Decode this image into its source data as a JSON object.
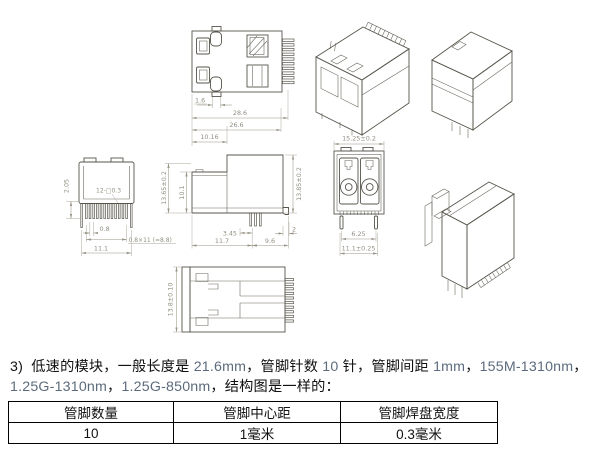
{
  "drawing": {
    "dims": {
      "top_tab": "1.6",
      "w_outer": "28.6",
      "w_body": "26.6",
      "w_nose": "10.16",
      "h_left": "13.65±0.2",
      "h_inner": "10.1",
      "h_right": "13.85±0.2",
      "pin_off": "3.45",
      "foot": "2",
      "b_left": "11.7",
      "b_right": "9.6",
      "tab_h": "2.05",
      "pads": "12-□0.3",
      "pitch": "0.8",
      "pitch_total": "0.8×11 (=8.8)",
      "row_w": "11.1",
      "fw": "15.25±0.2",
      "leg_pitch": "6.25",
      "leg_span": "11.1±0.25",
      "h_top": "13.8±0.10"
    }
  },
  "paragraph": {
    "segments": [
      {
        "t": "zh",
        "text": "3)  低速的模块，一般长度是 "
      },
      {
        "t": "en",
        "text": "21.6mm"
      },
      {
        "t": "zh",
        "text": "，管脚针数 "
      },
      {
        "t": "en",
        "text": "10"
      },
      {
        "t": "zh",
        "text": " 针，管脚间距 "
      },
      {
        "t": "en",
        "text": "1mm"
      },
      {
        "t": "zh",
        "text": "，"
      },
      {
        "t": "en",
        "text": "155M-1310nm"
      },
      {
        "t": "zh",
        "text": "，"
      },
      {
        "t": "br"
      },
      {
        "t": "en",
        "text": "1.25G-1310nm"
      },
      {
        "t": "zh",
        "text": "，"
      },
      {
        "t": "en",
        "text": "1.25G-850nm"
      },
      {
        "t": "zh",
        "text": "，结构图是一样的："
      }
    ]
  },
  "table": {
    "headers": [
      "管脚数量",
      "管脚中心距",
      "管脚焊盘宽度"
    ],
    "values": [
      "10",
      "1毫米",
      "0.3毫米"
    ]
  }
}
